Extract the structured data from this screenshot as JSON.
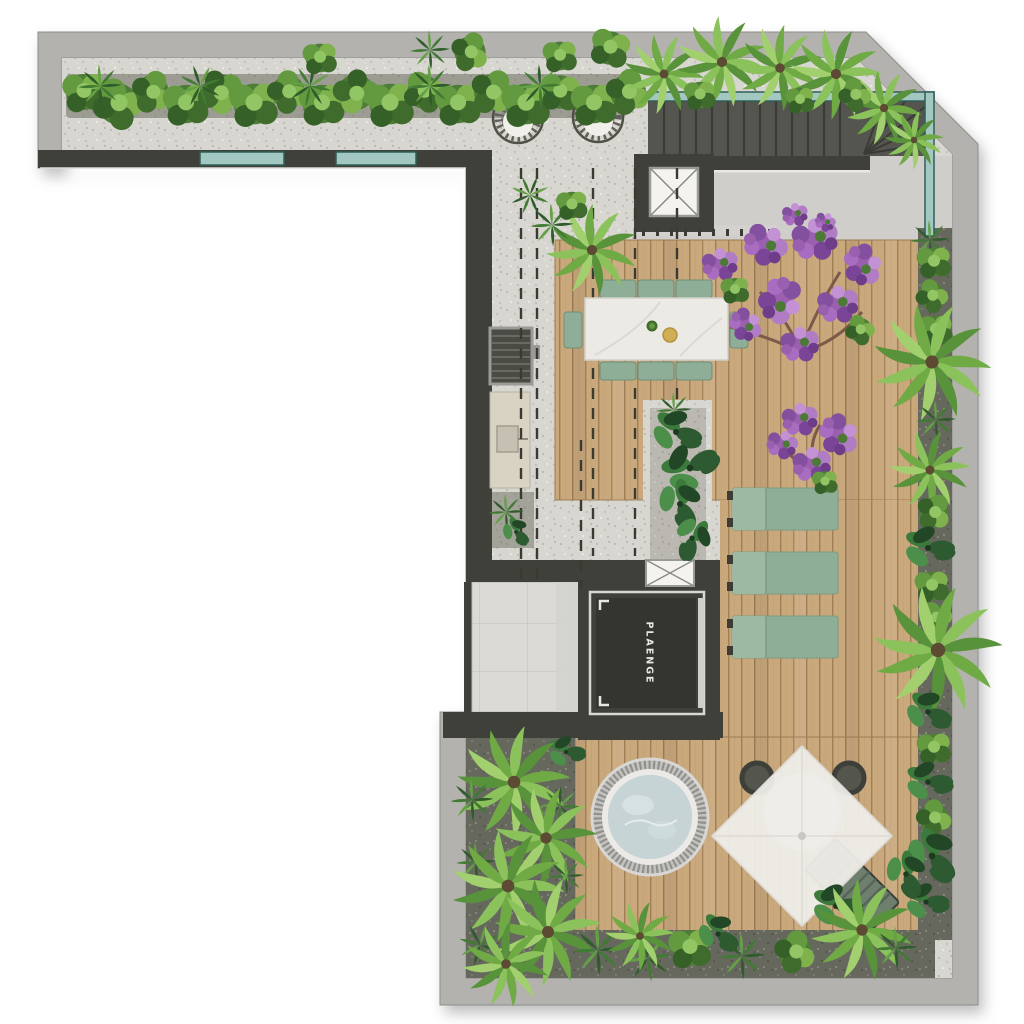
{
  "meta": {
    "title": "Rooftop terrace floor plan",
    "view": "top-down architectural render",
    "floor": "roof level"
  },
  "labels": {
    "elevator_brand": "PLAENGE"
  },
  "palette": {
    "wall_light": "#b3b2ae",
    "wall_dark": "#3f4039",
    "concrete": "#cfceca",
    "gravel_light": "#d8d6d0",
    "gravel_dark": "#66685e",
    "wood": "#c9a87c",
    "wood_gap": "#a07e56",
    "glass": "#a2c8c1",
    "glass_frame": "#2f5f57",
    "sage": "#8fae97",
    "sage_dark": "#6f8f78",
    "marble": "#eceae5",
    "water": "#c6d4d6",
    "tile": "#dbdad6",
    "cab": "#34352f",
    "text_light": "#e9e8e4",
    "leaf_dark": "#2f5c2b",
    "leaf_mid": "#4e7d38",
    "leaf_light": "#8cc25c",
    "purple": "#9a5fae",
    "trunk": "#7a5a48",
    "gold": "#cfae55"
  },
  "inventory": {
    "items": [
      "perimeter hedge planting",
      "hanging egg chairs (2)",
      "glass-railed staircase",
      "elevator shafts with X mark (2)",
      "service elevator cab (PLAENGE)",
      "outdoor dining table with 8 chairs",
      "bougainvillea trees (2)",
      "sun loungers (3)",
      "grill counter with sink",
      "tiled utility room",
      "round hot tub",
      "cantilever umbrella with bistro set",
      "timber decking",
      "gravel terrace with projection lines",
      "tropical palm garden beds"
    ]
  }
}
